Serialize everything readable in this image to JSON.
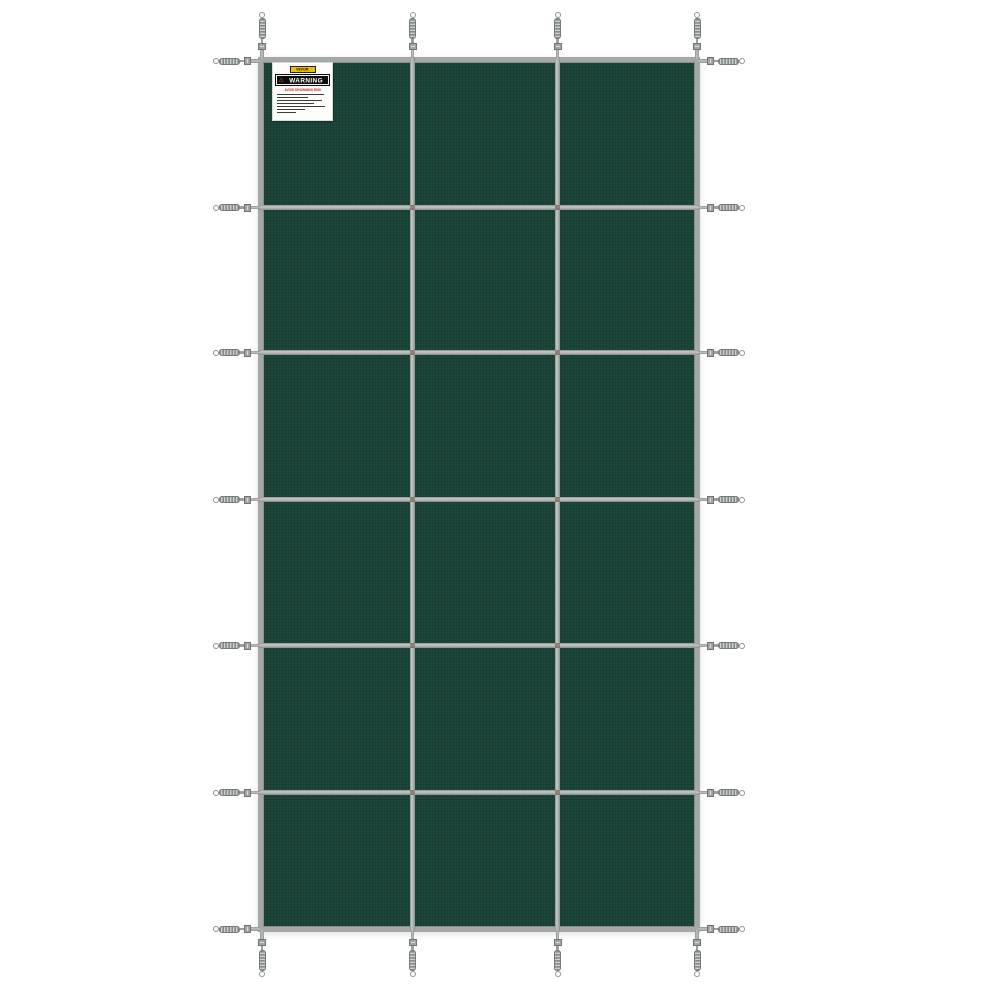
{
  "meta": {
    "scene": "Product photo of a rectangular dark-green mesh swimming pool safety cover with gray webbing straps and stainless spring anchors, on a white background"
  },
  "colors": {
    "background": "#ffffff",
    "fabric_green": "#1d473c",
    "strap_gray": "#a4a9a8",
    "hardware_gray": "#b0b5b4",
    "label_yellow": "#eebe00",
    "warning_black": "#0d0d0d",
    "warning_red": "#c22718",
    "triangle_orange": "#e05a00"
  },
  "cover": {
    "panel_cols": 3,
    "panel_rows": 6,
    "anchor_straps": {
      "top": 4,
      "bottom": 4,
      "left": 7,
      "right": 7
    }
  },
  "warning_label": {
    "brand": "VEVOR",
    "warning_icon": "⚠",
    "warning_title": "WARNING",
    "heading": "AVOID DROWNING RISK",
    "fine_print_line_widths": [
      92,
      60,
      88,
      72,
      95,
      55,
      38
    ]
  }
}
